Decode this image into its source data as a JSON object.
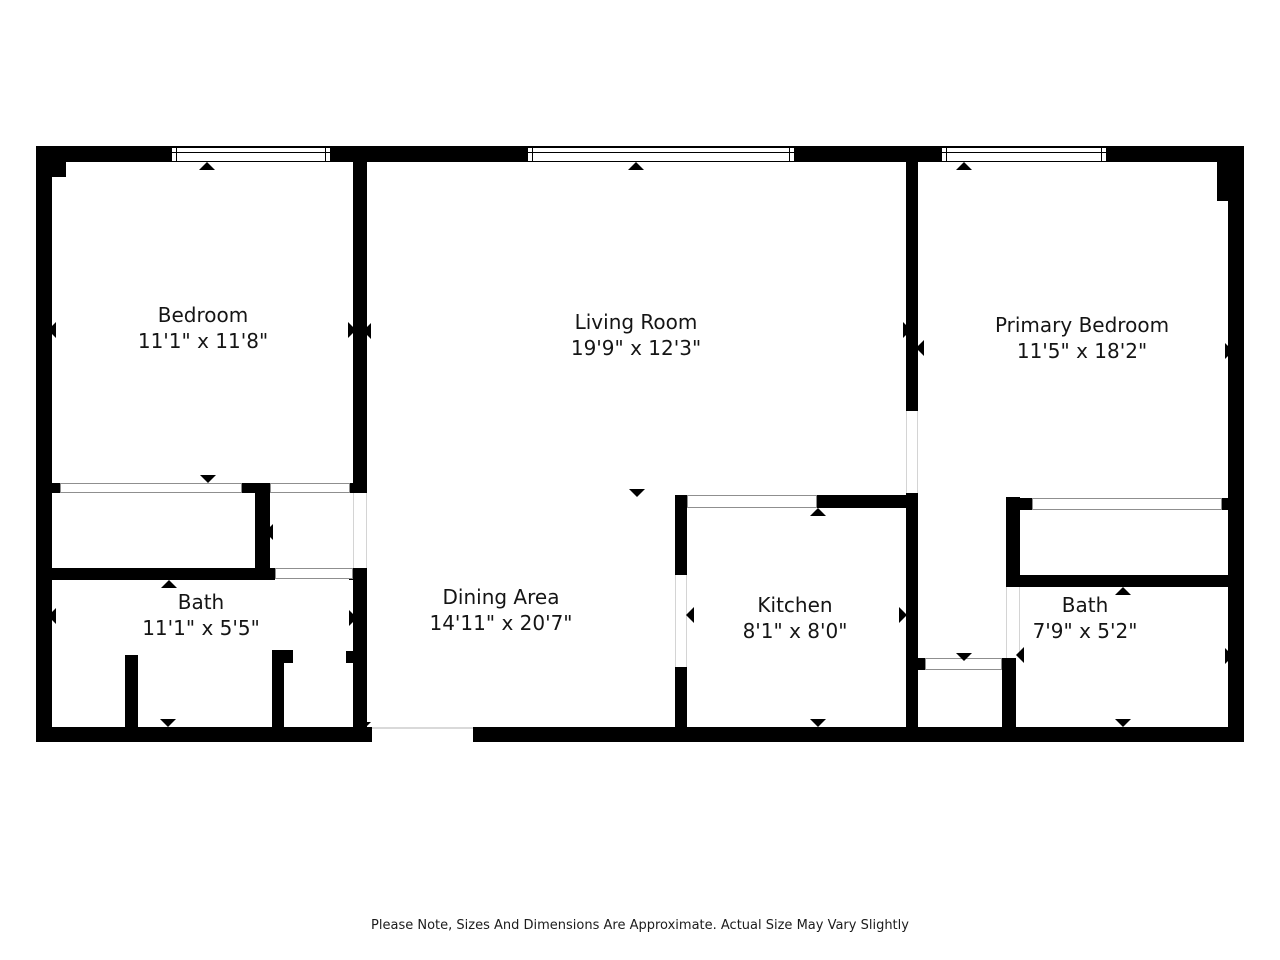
{
  "canvas": {
    "width": 1280,
    "height": 960,
    "background": "#ffffff",
    "wall_color": "#000000"
  },
  "footer": {
    "note": "Please Note, Sizes And Dimensions Are Approximate. Actual Size May Vary Slightly"
  },
  "rooms": [
    {
      "id": "bedroom",
      "name": "Bedroom",
      "dims": "11'1\" x 11'8\"",
      "cx": 203,
      "cy": 328
    },
    {
      "id": "living-room",
      "name": "Living Room",
      "dims": "19'9\" x 12'3\"",
      "cx": 636,
      "cy": 335
    },
    {
      "id": "primary-bedroom",
      "name": "Primary Bedroom",
      "dims": "11'5\" x 18'2\"",
      "cx": 1082,
      "cy": 338
    },
    {
      "id": "bath-left",
      "name": "Bath",
      "dims": "11'1\" x 5'5\"",
      "cx": 201,
      "cy": 615
    },
    {
      "id": "dining-area",
      "name": "Dining Area",
      "dims": "14'11\" x 20'7\"",
      "cx": 501,
      "cy": 610
    },
    {
      "id": "kitchen",
      "name": "Kitchen",
      "dims": "8'1\" x 8'0\"",
      "cx": 795,
      "cy": 618
    },
    {
      "id": "bath-right",
      "name": "Bath",
      "dims": "7'9\" x 5'2\"",
      "cx": 1085,
      "cy": 618
    }
  ],
  "geometry": {
    "walls": [
      {
        "name": "outer-wall-top",
        "x": 36,
        "y": 146,
        "w": 1208,
        "h": 16
      },
      {
        "name": "outer-wall-left",
        "x": 36,
        "y": 146,
        "w": 16,
        "h": 596
      },
      {
        "name": "outer-wall-left-corner-block",
        "x": 36,
        "y": 146,
        "w": 30,
        "h": 31
      },
      {
        "name": "outer-wall-right",
        "x": 1228,
        "y": 146,
        "w": 16,
        "h": 596
      },
      {
        "name": "outer-wall-right-corner-block",
        "x": 1217,
        "y": 146,
        "w": 27,
        "h": 55
      },
      {
        "name": "outer-wall-bottom-left",
        "x": 36,
        "y": 727,
        "w": 336,
        "h": 15
      },
      {
        "name": "outer-wall-bottom-right",
        "x": 473,
        "y": 727,
        "w": 771,
        "h": 15
      },
      {
        "name": "wall-bedroom-living",
        "x": 353,
        "y": 162,
        "w": 14,
        "h": 321
      },
      {
        "name": "wall-bedroom-living-cap",
        "x": 349,
        "y": 483,
        "w": 18,
        "h": 10
      },
      {
        "name": "wall-bath-dining",
        "x": 353,
        "y": 568,
        "w": 14,
        "h": 159
      },
      {
        "name": "wall-bath-dining-jamb",
        "x": 346,
        "y": 651,
        "w": 7,
        "h": 12
      },
      {
        "name": "wall-closet-divider",
        "x": 255,
        "y": 493,
        "w": 15,
        "h": 77
      },
      {
        "name": "wall-closet-divider-cap",
        "x": 242,
        "y": 483,
        "w": 28,
        "h": 10
      },
      {
        "name": "wall-bedroom-closet-cap",
        "x": 42,
        "y": 483,
        "w": 18,
        "h": 10
      },
      {
        "name": "wall-bath-top",
        "x": 36,
        "y": 568,
        "w": 239,
        "h": 12
      },
      {
        "name": "wall-bath-top-cap",
        "x": 349,
        "y": 568,
        "w": 18,
        "h": 12
      },
      {
        "name": "wall-bath-fixture-left",
        "x": 125,
        "y": 655,
        "w": 13,
        "h": 72
      },
      {
        "name": "wall-bath-fixture-right",
        "x": 272,
        "y": 650,
        "w": 12,
        "h": 77
      },
      {
        "name": "wall-bath-fixture-right-stub",
        "x": 283,
        "y": 650,
        "w": 10,
        "h": 13
      },
      {
        "name": "wall-kitchen-left-upper",
        "x": 675,
        "y": 495,
        "w": 12,
        "h": 80
      },
      {
        "name": "wall-kitchen-left-lower",
        "x": 675,
        "y": 667,
        "w": 12,
        "h": 60
      },
      {
        "name": "wall-kitchen-top-solid",
        "x": 817,
        "y": 495,
        "w": 91,
        "h": 13
      },
      {
        "name": "wall-living-primary",
        "x": 906,
        "y": 162,
        "w": 12,
        "h": 249
      },
      {
        "name": "wall-kitchen-right",
        "x": 906,
        "y": 493,
        "w": 12,
        "h": 234
      },
      {
        "name": "wall-hall-door-cap",
        "x": 918,
        "y": 658,
        "w": 7,
        "h": 12
      },
      {
        "name": "wall-hall-right",
        "x": 1002,
        "y": 658,
        "w": 14,
        "h": 69
      },
      {
        "name": "wall-primary-closet-left",
        "x": 1006,
        "y": 497,
        "w": 14,
        "h": 90
      },
      {
        "name": "wall-primary-closet-cap-left",
        "x": 1006,
        "y": 498,
        "w": 26,
        "h": 12
      },
      {
        "name": "wall-primary-closet-cap-right",
        "x": 1222,
        "y": 498,
        "w": 11,
        "h": 12
      },
      {
        "name": "wall-bath2-top",
        "x": 1006,
        "y": 575,
        "w": 227,
        "h": 12
      }
    ],
    "windows": [
      {
        "name": "window-bedroom",
        "x": 171,
        "y": 147,
        "w": 160,
        "h": 15
      },
      {
        "name": "window-living-room",
        "x": 527,
        "y": 147,
        "w": 268,
        "h": 15
      },
      {
        "name": "window-primary-bedroom",
        "x": 941,
        "y": 147,
        "w": 166,
        "h": 15
      }
    ],
    "closet_bands": [
      {
        "name": "closet-doors-bedroom",
        "x": 60,
        "y": 483,
        "w": 182,
        "h": 10
      },
      {
        "name": "opening-bedroom-hall",
        "x": 270,
        "y": 483,
        "w": 80,
        "h": 10
      },
      {
        "name": "opening-bath-hall",
        "x": 275,
        "y": 568,
        "w": 78,
        "h": 11
      },
      {
        "name": "kitchen-pass-through",
        "x": 687,
        "y": 495,
        "w": 130,
        "h": 13
      },
      {
        "name": "closet-doors-primary",
        "x": 1032,
        "y": 498,
        "w": 190,
        "h": 12
      },
      {
        "name": "hall-door-band",
        "x": 925,
        "y": 658,
        "w": 77,
        "h": 12
      }
    ],
    "door_gaps": [
      {
        "name": "door-living-primary",
        "x": 906,
        "y": 411,
        "w": 12,
        "h": 82,
        "side": "lr"
      },
      {
        "name": "door-dining-hall",
        "x": 353,
        "y": 493,
        "w": 14,
        "h": 75,
        "side": "lr"
      },
      {
        "name": "door-kitchen-left",
        "x": 675,
        "y": 575,
        "w": 12,
        "h": 92,
        "side": "lr"
      },
      {
        "name": "door-bath2-left",
        "x": 1006,
        "y": 587,
        "w": 14,
        "h": 71,
        "side": "lr"
      },
      {
        "name": "entry-opening-bottom",
        "x": 372,
        "y": 727,
        "w": 101,
        "h": 15,
        "side": "top"
      }
    ],
    "arrows": [
      {
        "dir": "up",
        "x": 207,
        "y": 162,
        "name": "window-marker-arrow"
      },
      {
        "dir": "up",
        "x": 636,
        "y": 162,
        "name": "window-marker-arrow"
      },
      {
        "dir": "up",
        "x": 964,
        "y": 162,
        "name": "window-marker-arrow"
      },
      {
        "dir": "up",
        "x": 169,
        "y": 580,
        "name": "door-arrow"
      },
      {
        "dir": "up",
        "x": 818,
        "y": 508,
        "name": "door-arrow"
      },
      {
        "dir": "up",
        "x": 1123,
        "y": 587,
        "name": "door-arrow"
      },
      {
        "dir": "down",
        "x": 208,
        "y": 483,
        "name": "door-arrow"
      },
      {
        "dir": "down",
        "x": 637,
        "y": 497,
        "name": "door-arrow"
      },
      {
        "dir": "down",
        "x": 964,
        "y": 661,
        "name": "door-arrow"
      },
      {
        "dir": "down",
        "x": 168,
        "y": 727,
        "name": "door-arrow"
      },
      {
        "dir": "down",
        "x": 818,
        "y": 727,
        "name": "door-arrow"
      },
      {
        "dir": "down",
        "x": 1123,
        "y": 727,
        "name": "door-arrow"
      },
      {
        "dir": "down",
        "x": 366,
        "y": 727,
        "s": 5,
        "name": "entry-door-arrow"
      },
      {
        "dir": "left",
        "x": 48,
        "y": 330,
        "name": "door-arrow"
      },
      {
        "dir": "left",
        "x": 48,
        "y": 616,
        "name": "door-arrow"
      },
      {
        "dir": "left",
        "x": 363,
        "y": 331,
        "name": "door-arrow"
      },
      {
        "dir": "left",
        "x": 265,
        "y": 532,
        "name": "door-arrow"
      },
      {
        "dir": "left",
        "x": 686,
        "y": 615,
        "name": "door-arrow"
      },
      {
        "dir": "left",
        "x": 916,
        "y": 348,
        "name": "door-arrow"
      },
      {
        "dir": "left",
        "x": 1016,
        "y": 655,
        "name": "door-arrow"
      },
      {
        "dir": "right",
        "x": 356,
        "y": 330,
        "name": "door-arrow"
      },
      {
        "dir": "right",
        "x": 911,
        "y": 330,
        "name": "door-arrow"
      },
      {
        "dir": "right",
        "x": 1233,
        "y": 351,
        "name": "door-arrow"
      },
      {
        "dir": "right",
        "x": 1233,
        "y": 656,
        "name": "door-arrow"
      },
      {
        "dir": "right",
        "x": 357,
        "y": 618,
        "name": "door-arrow"
      },
      {
        "dir": "right",
        "x": 907,
        "y": 615,
        "name": "door-arrow"
      }
    ]
  }
}
